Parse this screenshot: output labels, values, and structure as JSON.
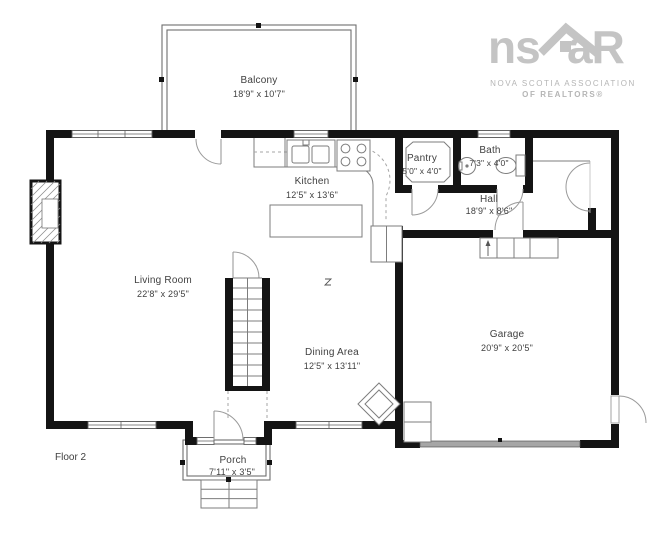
{
  "logo": {
    "text_ns": "ns",
    "text_ar": "aR",
    "caption_line1": "NOVA SCOTIA ASSOCIATION",
    "caption_line2": "OF REALTORS®"
  },
  "floor_label": "Floor 2",
  "rooms": {
    "balcony": {
      "name": "Balcony",
      "dims": "18'9\" x 10'7\""
    },
    "kitchen": {
      "name": "Kitchen",
      "dims": "12'5\" x 13'6\""
    },
    "pantry": {
      "name": "Pantry",
      "dims": "5'0\" x 4'0\""
    },
    "bath": {
      "name": "Bath",
      "dims": "7'3\" x 4'0\""
    },
    "hall": {
      "name": "Hall",
      "dims": "18'9\" x 8'6\""
    },
    "living_room": {
      "name": "Living Room",
      "dims": "22'8\" x 29'5\""
    },
    "dining_area": {
      "name": "Dining Area",
      "dims": "12'5\" x 13'11\""
    },
    "garage": {
      "name": "Garage",
      "dims": "20'9\" x 20'5\""
    },
    "porch": {
      "name": "Porch",
      "dims": "7'11\" x 3'5\""
    }
  },
  "colors": {
    "wall": "#141414",
    "thin_line": "#7d7d7d",
    "label_text": "#404040",
    "logo_gray": "#c4c4c4",
    "garage_door": "#a6a6a6",
    "background": "#ffffff"
  }
}
